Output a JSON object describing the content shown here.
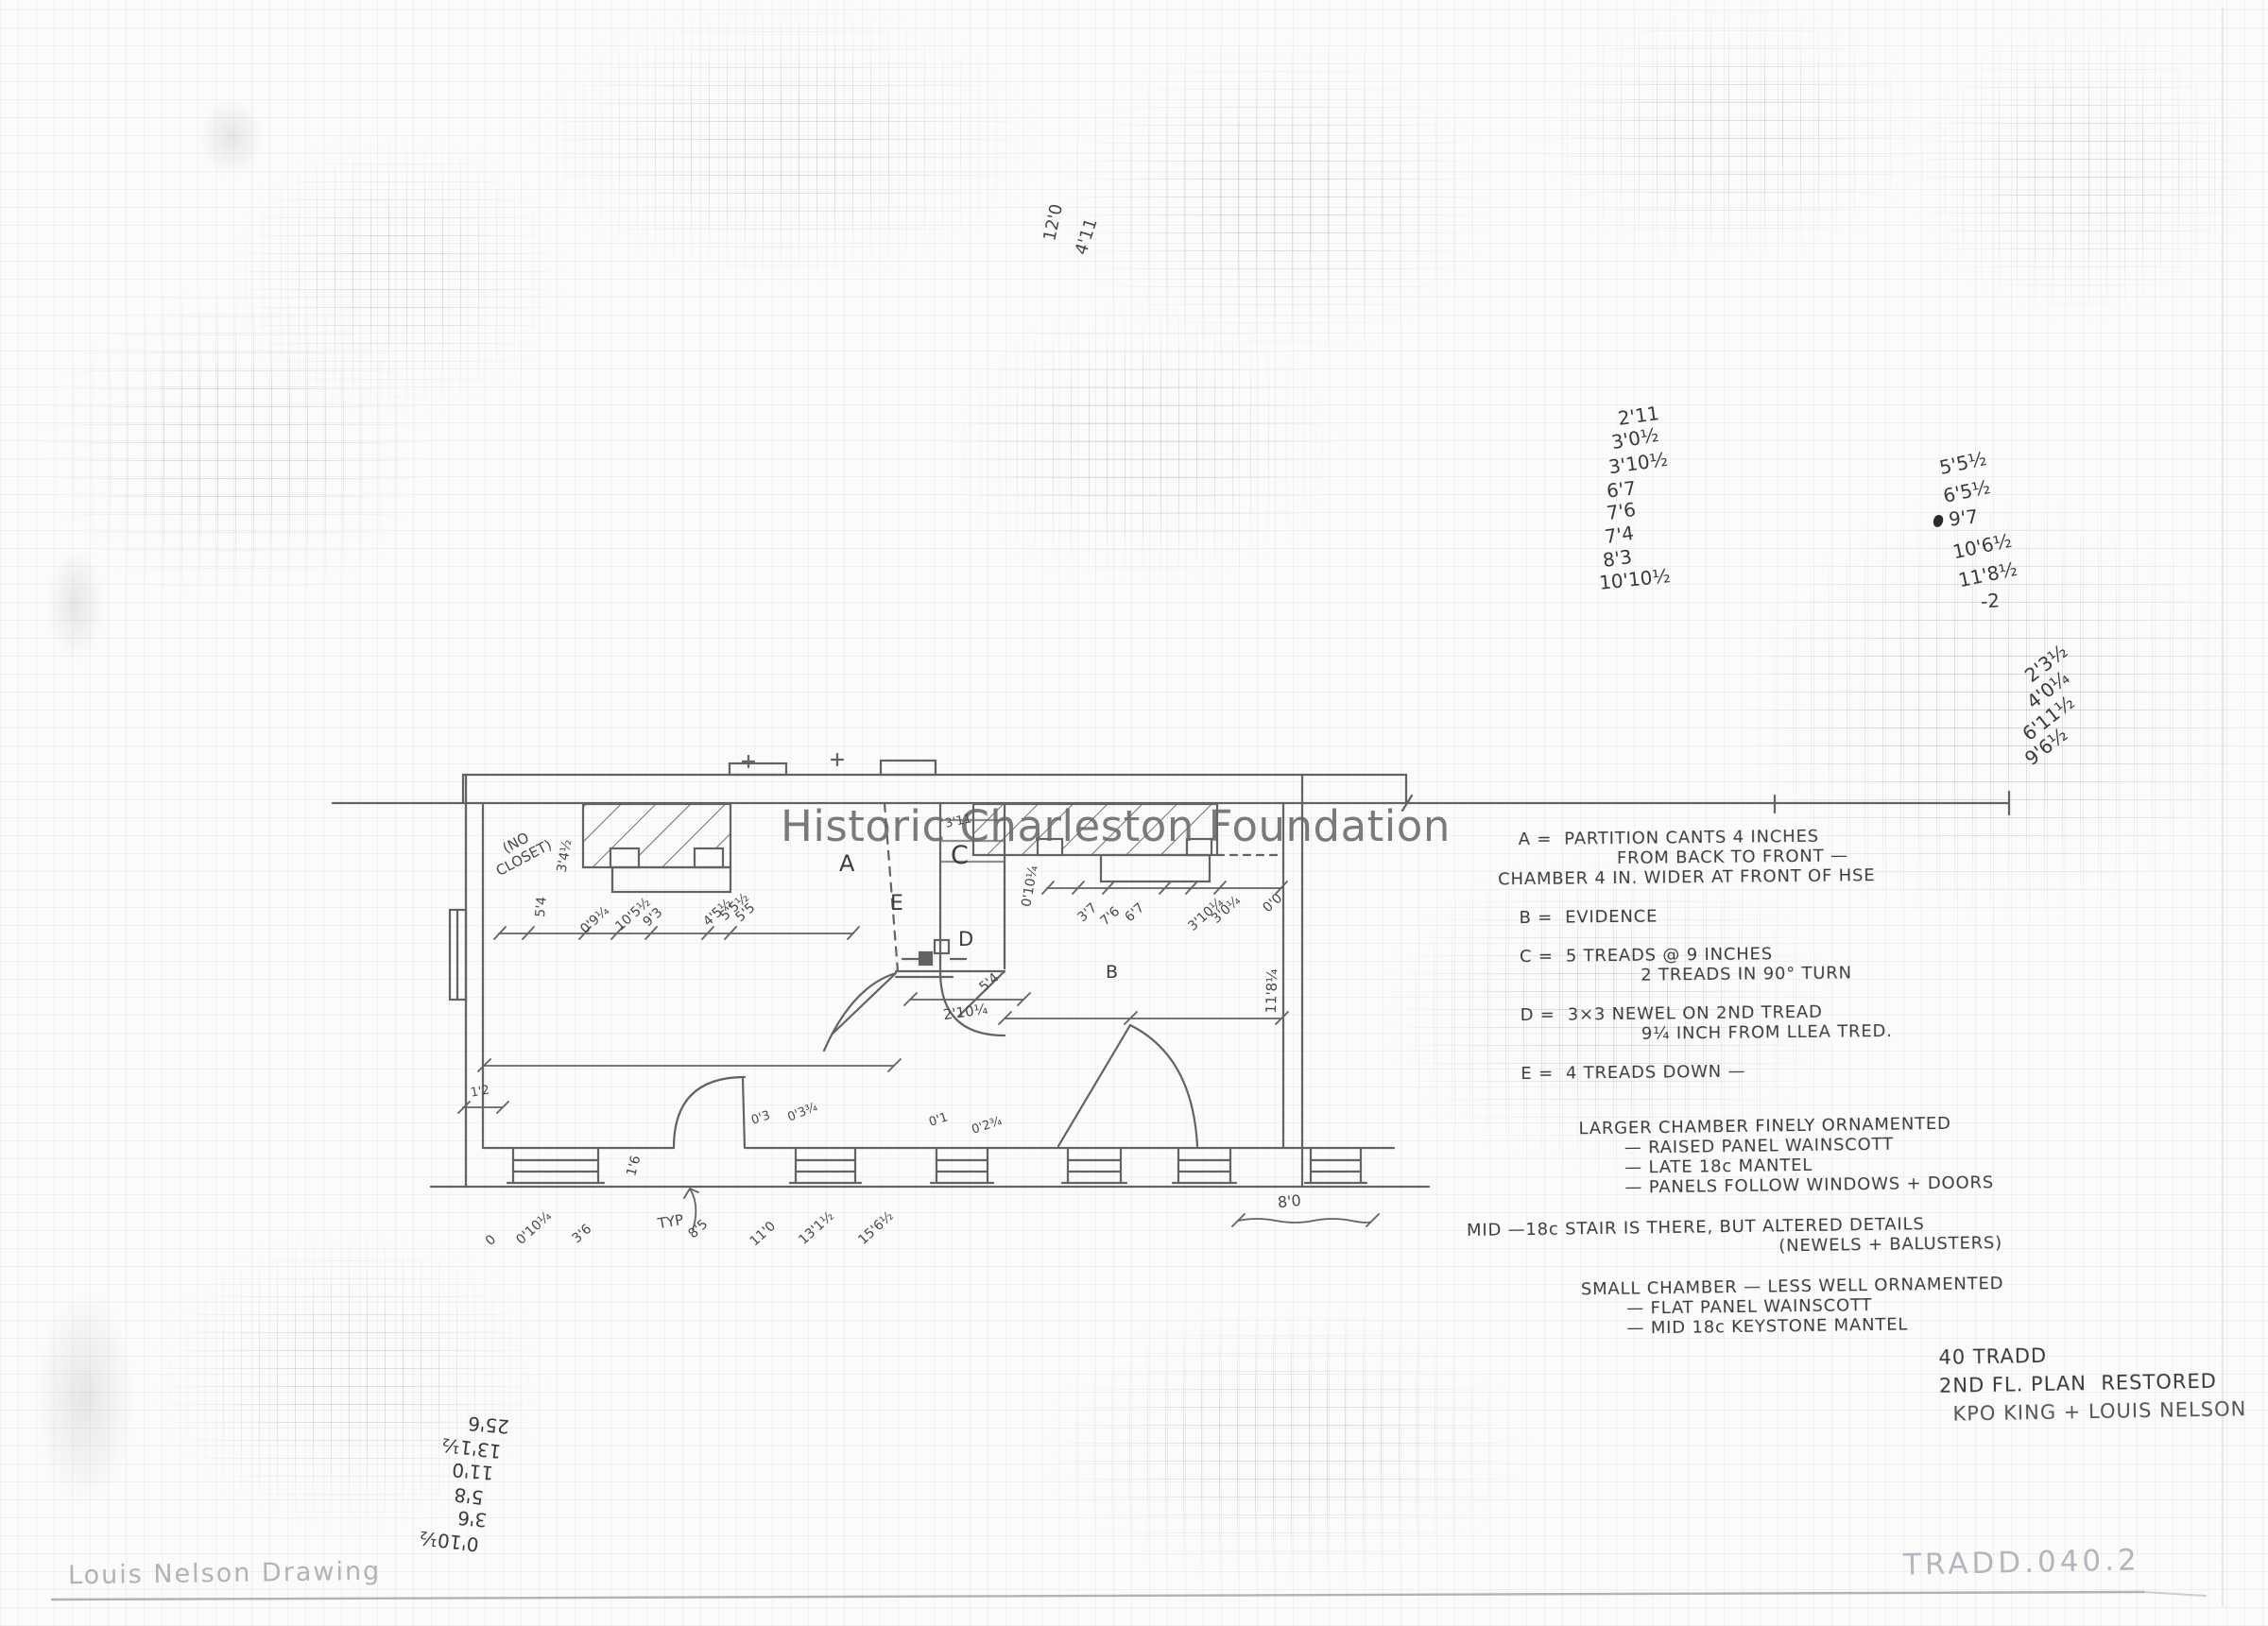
{
  "page": {
    "watermark": "Historic Charleston Foundation",
    "signature": "Louis Nelson Drawing",
    "catalog_number": "TRADD.040.2"
  },
  "title_block": {
    "address": "40 TRADD",
    "plan_title": "2ND FL. PLAN  RESTORED",
    "authors": "KPO KING + LOUIS NELSON"
  },
  "legend": {
    "lines": [
      "A =  PARTITION CANTS 4 INCHES",
      "FROM BACK TO FRONT —",
      "CHAMBER 4 IN. WIDER AT FRONT OF HSE",
      "B =  EVIDENCE",
      "C =  5 TREADS @ 9 INCHES",
      "2 TREADS IN 90° TURN",
      "D =  3×3 NEWEL ON 2ND TREAD",
      "9¼ INCH FROM LLEA TRED.",
      "E =  4 TREADS DOWN —"
    ]
  },
  "notes": {
    "lines": [
      "LARGER CHAMBER FINELY ORNAMENTED",
      "— RAISED PANEL WAINSCOTT",
      "— LATE 18c MANTEL",
      "— PANELS FOLLOW WINDOWS + DOORS",
      "MID —18c STAIR IS THERE, BUT ALTERED DETAILS",
      "(NEWELS + BALUSTERS)",
      "SMALL CHAMBER — LESS WELL ORNAMENTED",
      "— FLAT PANEL WAINSCOTT",
      "— MID 18c KEYSTONE MANTEL"
    ]
  },
  "measurements": {
    "top_column": [
      "2'11",
      "3'0½",
      "3'10½",
      "6'7",
      "7'6",
      "7'4",
      "8'3",
      "10'10½"
    ],
    "right_column": [
      "5'5½",
      "6'5½",
      "9'7",
      "10'6½",
      "11'8½",
      "-2"
    ],
    "diagonal_column": [
      "2'3½",
      "4'0¼",
      "6'11½",
      "9'6½"
    ],
    "inverted_column": [
      "0'10½",
      "3'6",
      "5'8",
      "11'0",
      "13'1½",
      "25'6"
    ],
    "rotated_pair": [
      "12'0",
      "4'11"
    ]
  },
  "plan": {
    "letters": {
      "a": "A",
      "b": "B",
      "c": "C",
      "d": "D",
      "e": "E"
    },
    "no_closet_label": "(NO\nCLOSET)",
    "typ_label": "TYP",
    "scale_dim": "8'0",
    "bottom_dims": [
      "0",
      "0'10¼",
      "3'6",
      "8'5",
      "11'0",
      "13'1½",
      "15'6½"
    ],
    "left_room_dims": [
      "0'9¼",
      "10'5½",
      "9'3",
      "4'5½",
      "5'5½",
      "5'5"
    ],
    "right_room_dims": [
      "3'7",
      "7'6",
      "6'7",
      "3'10¼",
      "3'0¼",
      "0'0"
    ],
    "stair_dims": [
      "2'10¼",
      "5'4",
      "0'10¼",
      "3'11"
    ],
    "window_dims": [
      "1'6",
      "0'3",
      "0'3¾",
      "0'1",
      "0'2¾",
      "1'2"
    ],
    "closet_dims": [
      "3'4½",
      "5'4"
    ],
    "side_dim": "11'8¼"
  },
  "colors": {
    "pencil": "#47474b",
    "light_pencil": "#b4b4bc",
    "watermark_gray": "#6a6a6a",
    "paper": "#fbfbfa"
  }
}
